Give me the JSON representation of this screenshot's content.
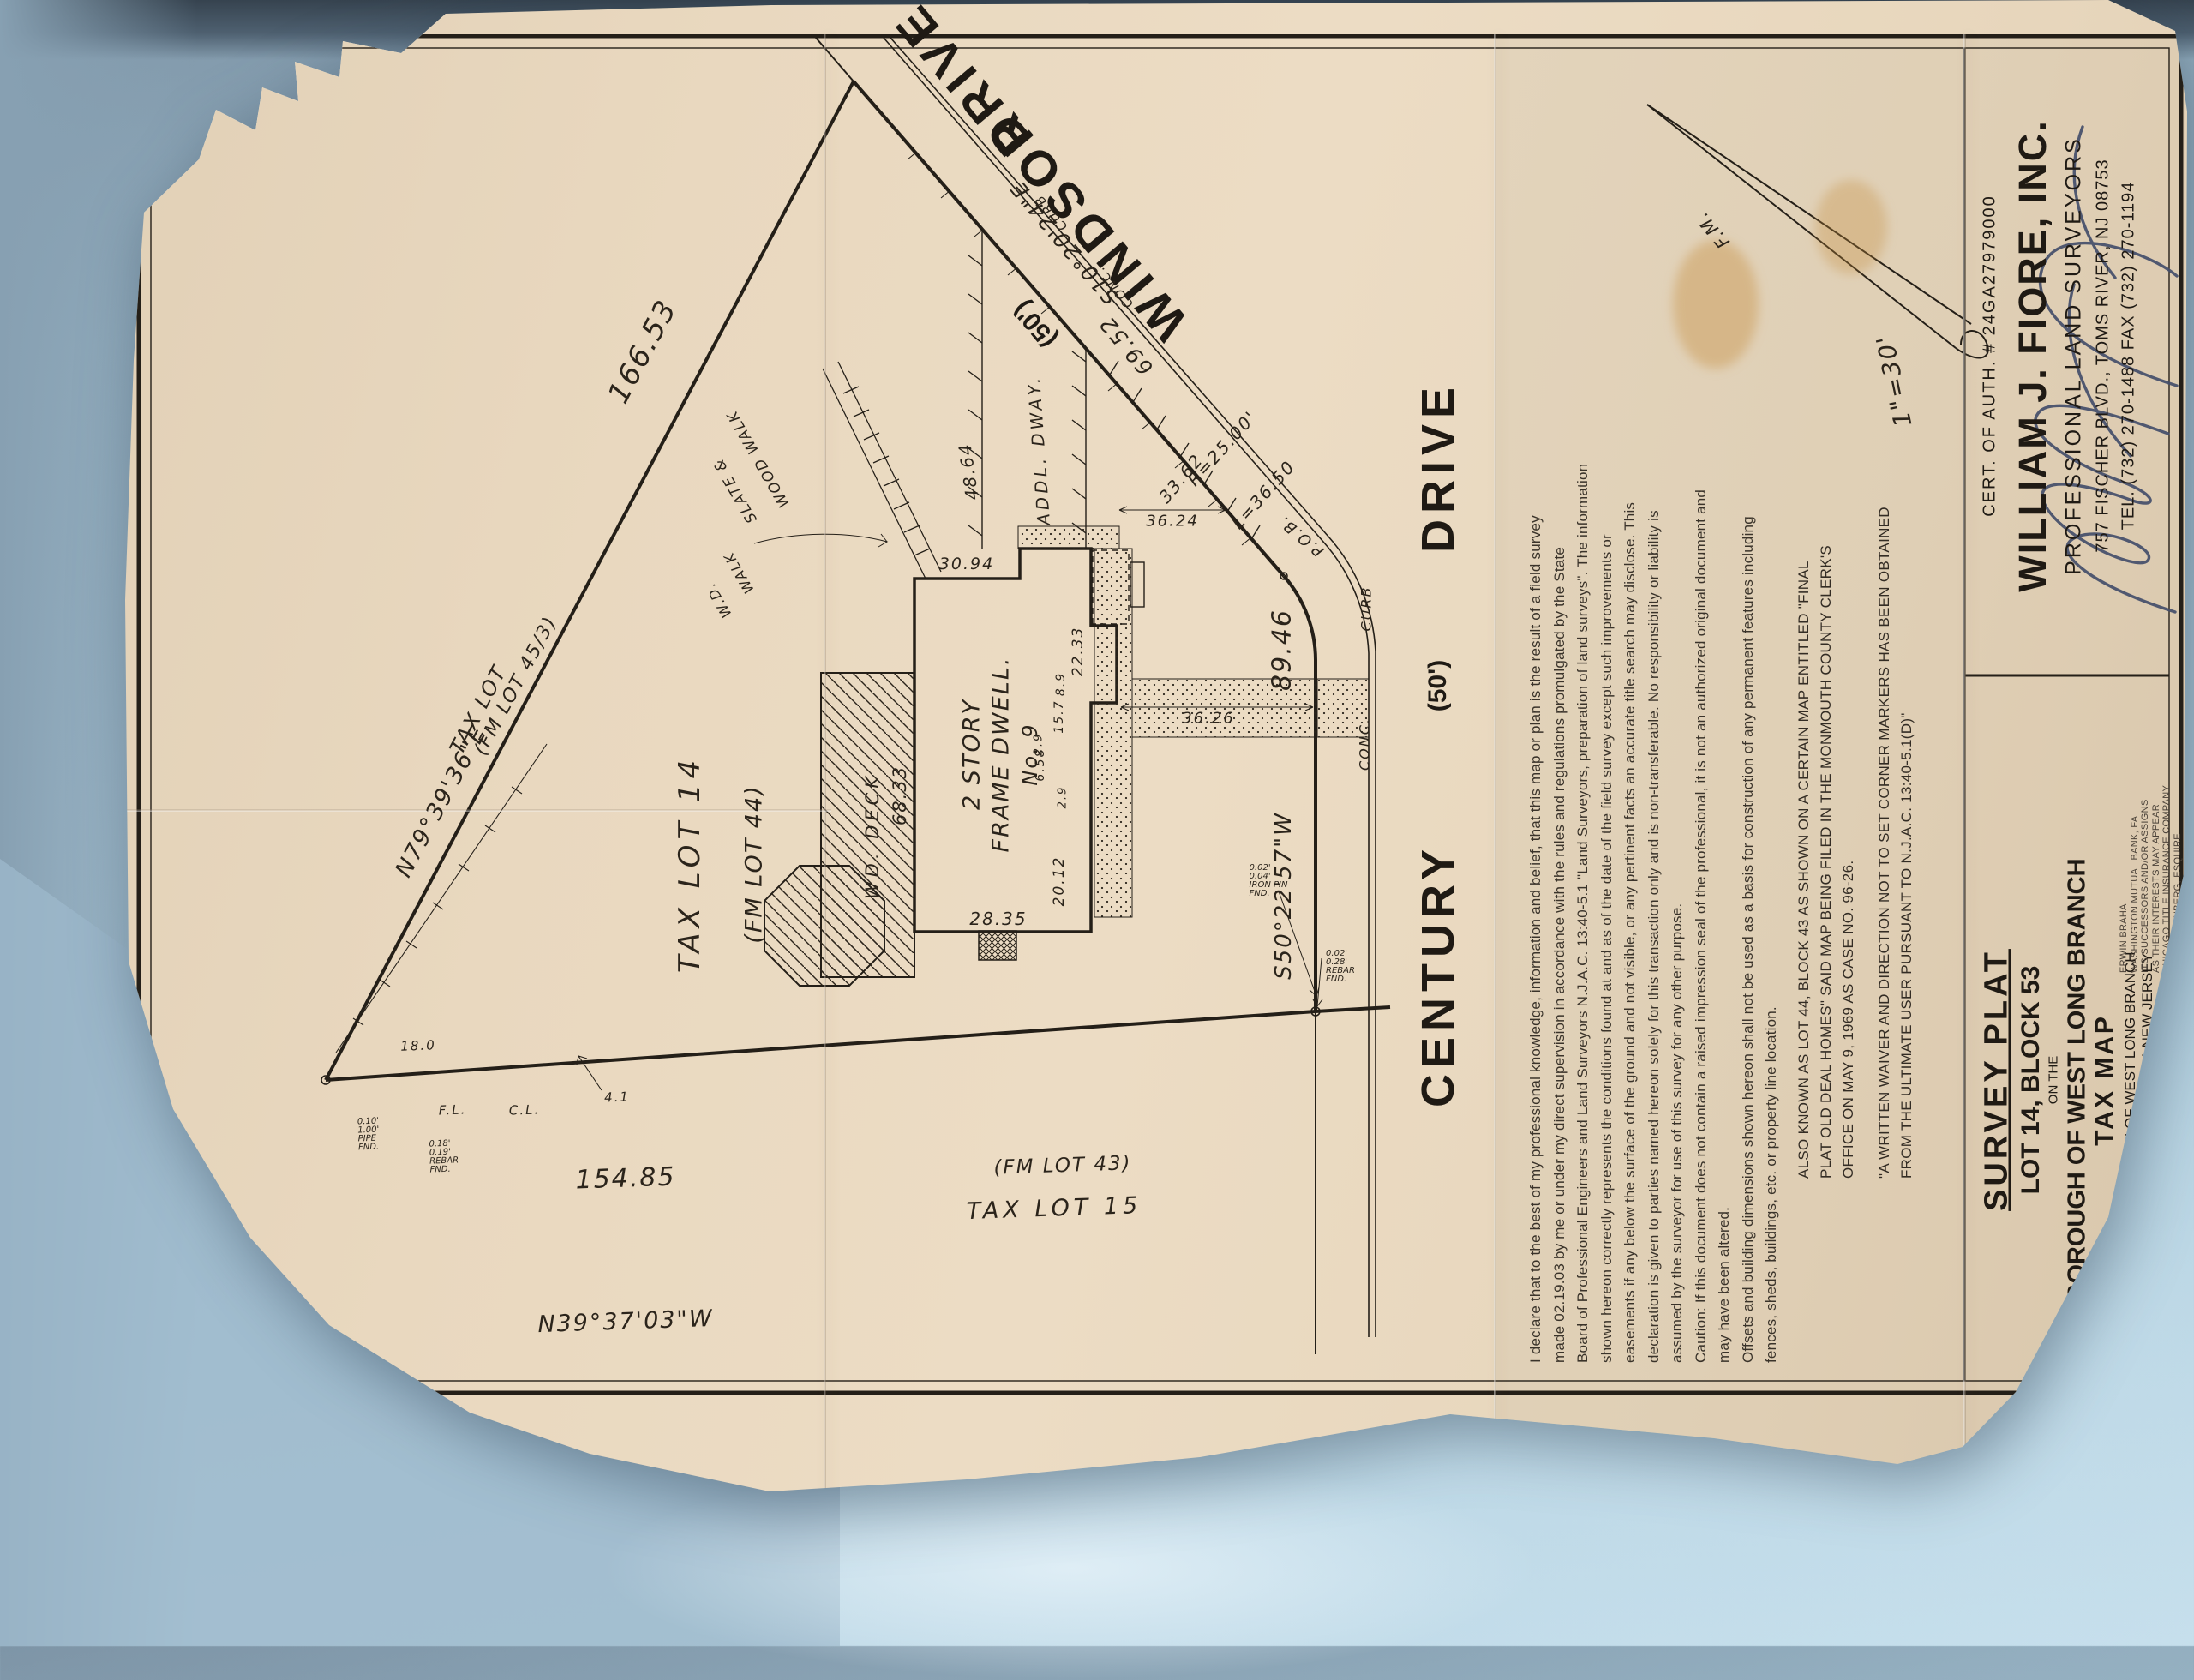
{
  "plat": {
    "streets": {
      "windsor": {
        "name": "WINDSOR",
        "type": "DRIVE",
        "width": "(50')"
      },
      "century": {
        "name": "CENTURY",
        "type": "DRIVE",
        "width": "(50')"
      }
    },
    "curb": {
      "conc": "CONC.",
      "curb": "CURB"
    },
    "boundary": {
      "north": {
        "bearing": "N79°39'36\"E",
        "distance": "166.53"
      },
      "west": {
        "bearing": "N39°37'03\"W",
        "distance": "154.85"
      },
      "century_front": {
        "bearing": "S50°22'57\"W",
        "distance": "89.46"
      },
      "windsor_front": {
        "bearing": "S10°20'24\"E",
        "distance": "69.52"
      },
      "curve": {
        "radius": "R=25.00'",
        "length": "L=36.50"
      },
      "pob": "P.O.B."
    },
    "lots": {
      "lot14": {
        "line1": "TAX LOT 14",
        "line2": "(FM LOT 44)"
      },
      "lot15": {
        "line1": "TAX LOT 15",
        "line2": "(FM LOT 43)"
      },
      "lot45": {
        "line1": "TAX LOT",
        "line2": "(FM LOT 45/3)"
      }
    },
    "house": {
      "line1": "2 STORY",
      "line2": "FRAME DWELL.",
      "line3": "No. 9"
    },
    "features": {
      "deck": "WD. DECK",
      "walk1a": "W.D.",
      "walk1b": "WALK",
      "walk2a": "SLATE &",
      "walk2b": "WOOD WALK",
      "driveway": "ADDL. DWAY."
    },
    "dims": {
      "top": "68.33",
      "right": "30.94",
      "left": "28.35",
      "front_left": "20.12",
      "front_right": "22.33",
      "jog1": "8.9",
      "jog2": "15.7",
      "jog3": "6.58",
      "jog4": "2.9",
      "jog5": "2.9",
      "to_windsor": "36.24",
      "to_century": "36.26",
      "drive_top": "48.64",
      "drive_flare": "33.62",
      "fence_off": "4.1",
      "corner_off": "18.0",
      "fence_cl": "C.L.",
      "fence_fl": "F.L."
    },
    "monuments": {
      "west_a": [
        "0.10'",
        "1.00'",
        "PIPE",
        "FND."
      ],
      "west_b": [
        "0.18'",
        "0.19'",
        "REBAR",
        "FND."
      ],
      "sw_a": [
        "0.02'",
        "0.28'",
        "REBAR",
        "FND."
      ],
      "sw_b": [
        "0.02'",
        "0.04'",
        "IRON PIN",
        "FND."
      ]
    },
    "annotations": {
      "scale": "1\"=30'",
      "north": "F.M."
    }
  },
  "declaration": {
    "lines": [
      "I declare that to the best of my professional knowledge, information and belief, that this map or plan is the result of a field survey",
      "made  02.19.03  by me or under my direct supervision in accordance with the rules and regulations promulgated by the State",
      "Board of Professional Engineers and Land Surveyors N.J.A.C. 13:40-5.1 \"Land Surveyors, preparation of land surveys\".  The information",
      "shown hereon correctly represents the conditions found at and as of the date of the field survey except such improvements or",
      "easements if any below the surface of the ground and not visible, or any pertinent facts an accurate title search may disclose.  This",
      "declaration is given to parties named hereon solely for this transaction only and is non-transferable.  No responsibility or liability is",
      "assumed by the surveyor for use of this survey for any other purpose.",
      "Caution: If this document does not contain a raised impression seal of the professional, it is not an authorized original document and",
      "may have been altered.",
      "Offsets and building dimensions shown hereon shall not be used as a basis for construction of any permanent features including",
      "fences, sheds, buildings, etc. or property line location."
    ]
  },
  "notes": {
    "also_known": [
      "ALSO KNOWN AS LOT 44, BLOCK 43 AS SHOWN ON A CERTAIN MAP ENTITLED \"FINAL",
      "PLAT OLD DEAL HOMES\" SAID MAP BEING FILED IN THE MONMOUTH COUNTY CLERK'S",
      "OFFICE ON MAY 9, 1969 AS CASE NO. 96-26."
    ],
    "waiver": [
      "\"A WRITTEN WAIVER AND DIRECTION NOT TO SET CORNER MARKERS HAS BEEN OBTAINED",
      "FROM THE ULTIMATE USER PURSUANT TO N.J.A.C. 13:40-5.1(D)\""
    ]
  },
  "title_block": {
    "survey_plat": "SURVEY PLAT",
    "lot_block": "LOT 14, BLOCK 53",
    "on_the": "ON THE",
    "borough": "BOROUGH OF WEST LONG BRANCH",
    "tax_map": "TAX MAP",
    "sub1": "BOROUGH OF WEST LONG BRANCH",
    "sub2": "MONMOUTH COUNTY, NEW JERSEY",
    "to": "TO:",
    "recipients": [
      "ERWIN BRAHA",
      "WASHINGTON MUTUAL BANK, FA",
      "ITS SUCCESSORS AND/OR ASSIGNS",
      "AS THEIR INTERESTS MAY APPEAR",
      "CHICAGO TITLE INSURANCE COMPANY",
      "DAVID EISENBERG, ESQUIRE"
    ]
  },
  "firm": {
    "cert": "CERT. OF AUTH. # 24GA27979000",
    "name": "WILLIAM J. FIORE, INC.",
    "profession": "PROFESSIONAL LAND SURVEYORS",
    "address": "757 FISCHER BLVD., TOMS RIVER, NJ 08753",
    "phones": "TEL. (732) 270-1488   FAX (732) 270-1194"
  }
}
